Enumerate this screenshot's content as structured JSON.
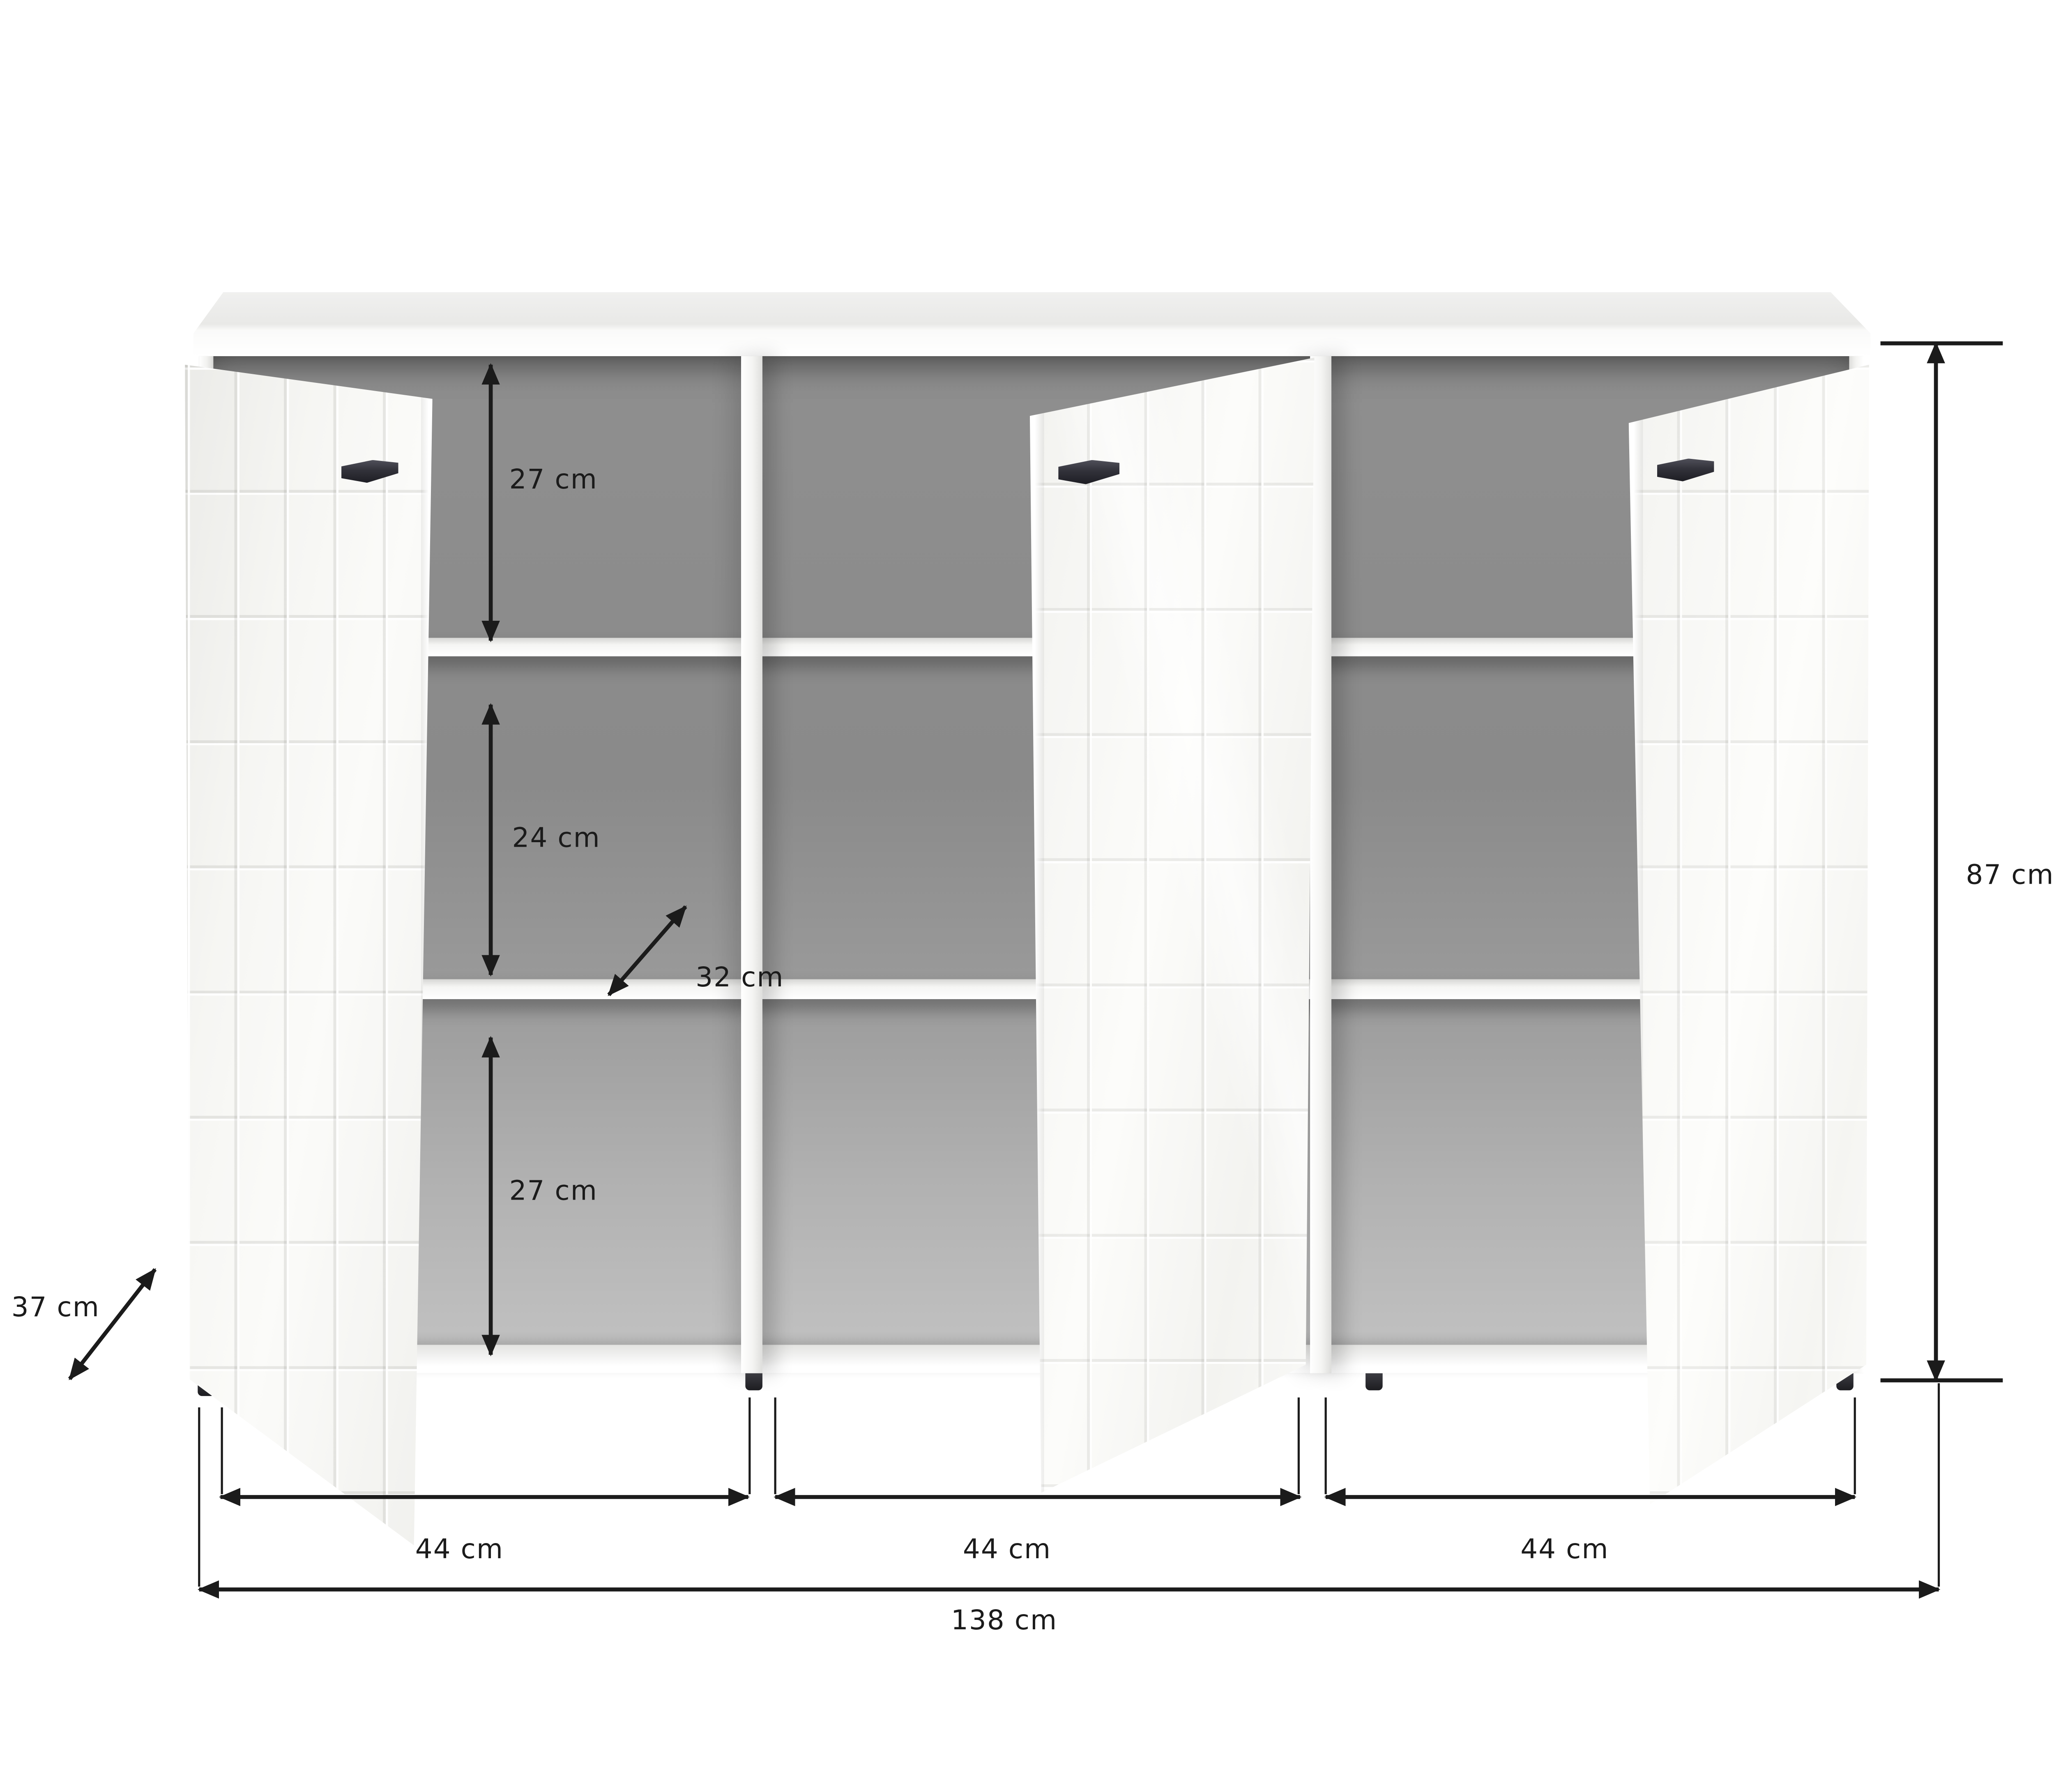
{
  "page": {
    "background": "#ffffff"
  },
  "diagram": {
    "type": "furniture-dimension-diagram",
    "subject": "sideboard with three tiled doors shown open, three compartments, two shelves each",
    "unit": "cm",
    "colors": {
      "annotation": "#1b1b1b",
      "interior_gray": "#909090",
      "body_white": "#f7f7f4",
      "handle_dark": "#2b2b31",
      "background": "#ffffff"
    },
    "structure": {
      "doors": 3,
      "compartments": 3,
      "shelves_per_compartment": 2,
      "feet": 4,
      "handles": 3
    },
    "measurements": {
      "inner_top_height": {
        "value": 27,
        "unit": "cm",
        "label": "27 cm"
      },
      "inner_middle_height": {
        "value": 24,
        "unit": "cm",
        "label": "24 cm"
      },
      "inner_depth": {
        "value": 32,
        "unit": "cm",
        "label": "32 cm"
      },
      "inner_bottom_height": {
        "value": 27,
        "unit": "cm",
        "label": "27 cm"
      },
      "depth": {
        "value": 37,
        "unit": "cm",
        "label": "37 cm"
      },
      "height": {
        "value": 87,
        "unit": "cm",
        "label": "87 cm"
      },
      "door_widths": [
        {
          "value": 44,
          "unit": "cm",
          "label": "44 cm"
        },
        {
          "value": 44,
          "unit": "cm",
          "label": "44 cm"
        },
        {
          "value": 44,
          "unit": "cm",
          "label": "44 cm"
        }
      ],
      "total_width": {
        "value": 138,
        "unit": "cm",
        "label": "138 cm"
      }
    }
  }
}
